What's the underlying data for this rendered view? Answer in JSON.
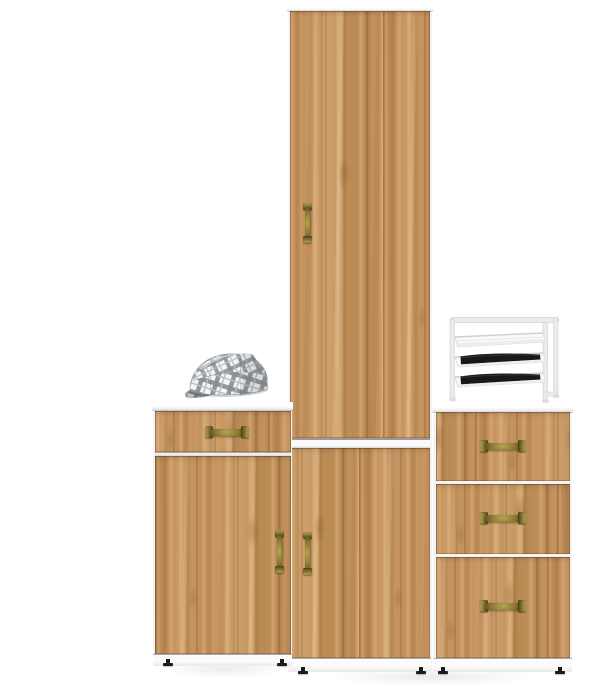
{
  "scene": {
    "type": "product-photo",
    "setting": "white studio background",
    "objects": {
      "left_cabinet": {
        "label": "oak hallway cabinet with one drawer and one door",
        "drawers": 1,
        "doors": 1,
        "handles": 2,
        "feet": 2
      },
      "tall_cabinet": {
        "label": "tall oak wardrobe column with upper and lower doors",
        "doors": 2,
        "handles": 2,
        "feet": 2
      },
      "right_chest": {
        "label": "oak chest of three drawers",
        "drawers": 3,
        "handles": 3,
        "feet": 2
      },
      "plaid_cap": {
        "label": "gray plaid flat cap lying on the left cabinet top"
      },
      "wire_rack": {
        "label": "white wire organizer rack with three slanted trays on the chest top",
        "trays": 3,
        "trays_with_items": 2
      }
    }
  },
  "colors": {
    "background": "#ffffff",
    "wood_base": "#c28f5c",
    "panel_white": "#fbfbfb",
    "carcass_white": "#f4f4f4",
    "brass_light": "#b7a452",
    "brass_mid": "#8a7a33",
    "brass_dark": "#4e431a",
    "foot_black": "#1c1c1c",
    "rack_frame": "#ebebeb",
    "rack_edge": "#d2d2d2",
    "tray_content_black": "#19191b",
    "cap_base": "#f5f5f5",
    "cap_stripe": "#878d93",
    "cap_stripe_thin": "#b8bdc2"
  }
}
